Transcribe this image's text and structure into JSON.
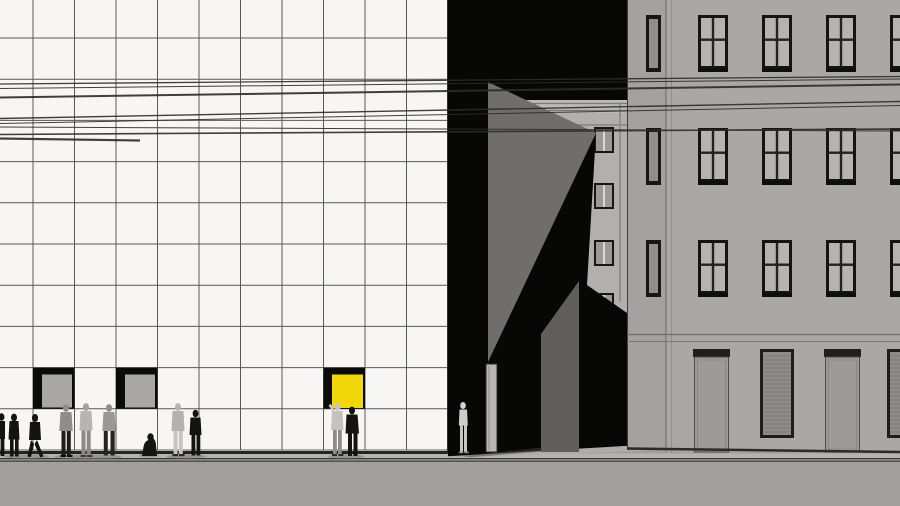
{
  "palette": {
    "facade_white": "#f7f6f4",
    "grid_line": "#3d3d3c",
    "window_frame_black": "#0b0b0a",
    "window_glass_grey": "#a9a8a6",
    "accent_yellow": "#f2d808",
    "passage_black": "#070706",
    "wedge_grey": "#6f6e6c",
    "courtyard_facade_grey": "#b1b0ad",
    "courtyard_band_grey": "#bcbbb8",
    "right_side_grey": "#a3a2a0",
    "right_facade_grey": "#a9a8a5",
    "right_window_glass": "#b5b4b1",
    "door_grey": "#9c9b98",
    "shutter_grey": "#8d8c89",
    "pillar_grey": "#5f5e5b",
    "slab_light": "#b7b6b3",
    "sidewalk_grey": "#b4b3b0",
    "floor_light": "#aeadaa",
    "road_grey": "#a1a09d",
    "curb_dark": "#4e4d4b",
    "wire_dark": "#2c2c2b",
    "figure_black": "#131312",
    "figure_grey": "#92918f",
    "figure_light": "#c2c1bf",
    "mannequin_light": "#cfceca"
  },
  "scene": {
    "left_building": {
      "type": "white-grid-facade",
      "grid_columns": 11,
      "grid_rows": 11,
      "openings": [
        {
          "kind": "window",
          "tone": "grey"
        },
        {
          "kind": "window",
          "tone": "grey"
        },
        {
          "kind": "window",
          "tone": "yellow"
        }
      ]
    },
    "passage": {
      "type": "dark-courtyard-gap",
      "elements": [
        "sunlit-wedge-wall",
        "courtyard-building",
        "courtyard-window-column",
        "grey-pillar",
        "door-slab",
        "mannequin-figure"
      ],
      "courtyard_window_rows": 4
    },
    "right_building": {
      "type": "classical-facade",
      "window_rows": 3,
      "window_columns": 4,
      "ground_floor": [
        "door",
        "shuttered-window",
        "door",
        "shuttered-window"
      ]
    },
    "street": {
      "elements": [
        "sidewalk",
        "curb",
        "road"
      ],
      "pedestrian_count": 12
    },
    "overhead_wires": 8
  }
}
